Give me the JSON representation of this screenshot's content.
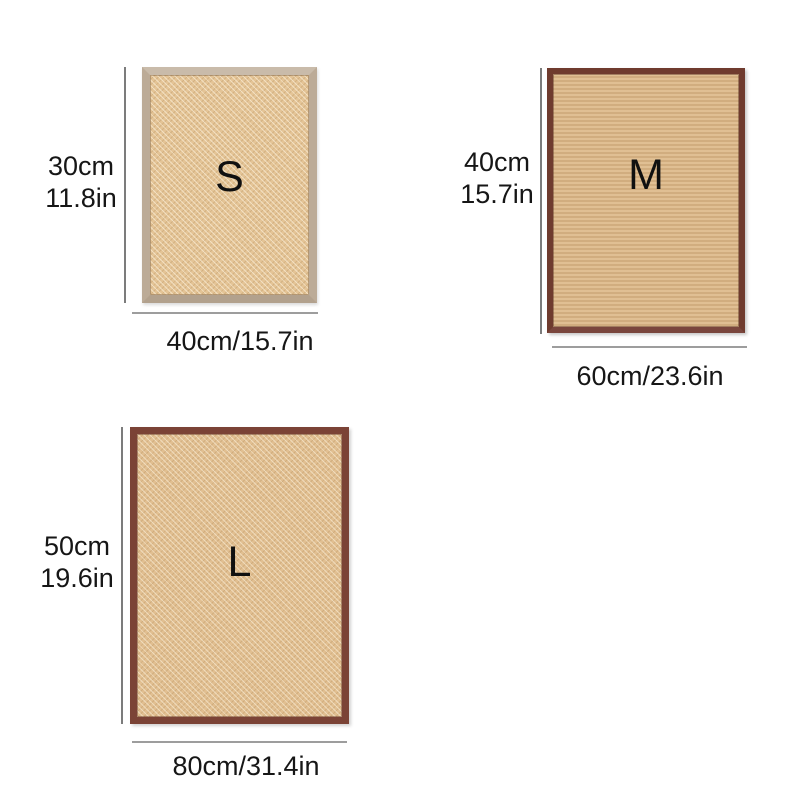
{
  "page": {
    "background": "#ffffff",
    "description_colors": {
      "s_frame": "#bcab97",
      "s_surface": "#e4c496",
      "m_frame": "#6f3b2e",
      "m_surface": "#d9b78a",
      "l_frame": "#7b4336",
      "l_surface": "#e1bf91",
      "dimension_line_vertical": "#7c7c7c",
      "dimension_line_horizontal": "#9d9d9d",
      "text": "#161616"
    }
  },
  "mats": [
    {
      "name": "S",
      "letter": "S",
      "height_label": {
        "cm": "30cm",
        "in": "11.8in"
      },
      "width_label": "40cm/15.7in"
    },
    {
      "name": "M",
      "letter": "M",
      "height_label": {
        "cm": "40cm",
        "in": "15.7in"
      },
      "width_label": "60cm/23.6in"
    },
    {
      "name": "L",
      "letter": "L",
      "height_label": {
        "cm": "50cm",
        "in": "19.6in"
      },
      "width_label": "80cm/31.4in"
    }
  ]
}
